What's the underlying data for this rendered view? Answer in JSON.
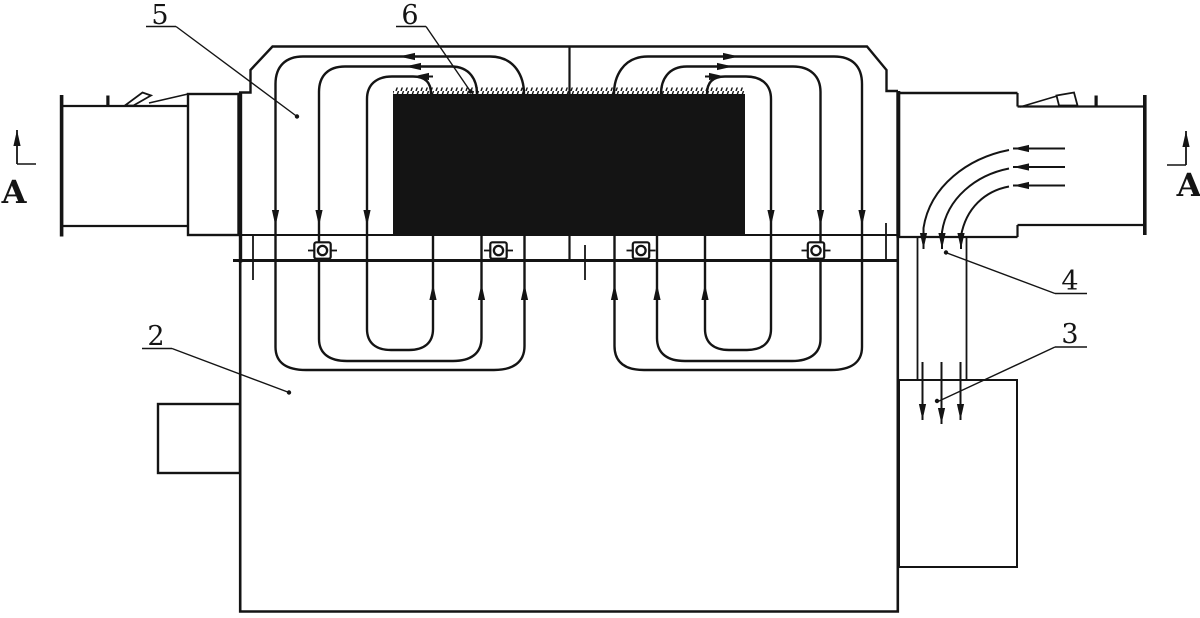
{
  "colors": {
    "background": "#ffffff",
    "ink": "#141414"
  },
  "labels": {
    "part_2": "2",
    "part_3": "3",
    "part_4": "4",
    "part_5": "5",
    "part_6": "6",
    "section_left": "A",
    "section_right": "A"
  }
}
